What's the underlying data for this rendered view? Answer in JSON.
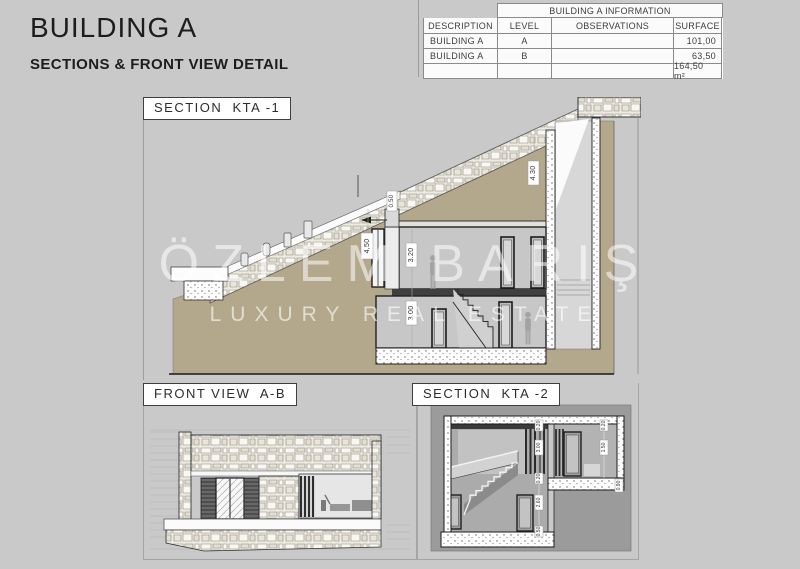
{
  "page": {
    "background": "#c9c9c9"
  },
  "header": {
    "title": "BUILDING A",
    "subtitle": "SECTIONS & FRONT VIEW DETAIL"
  },
  "info_table": {
    "title": "BUILDING A INFORMATION",
    "columns": [
      "DESCRIPTION",
      "LEVEL",
      "OBSERVATIONS",
      "SURFACE"
    ],
    "rows": [
      [
        "BUILDING A",
        "A",
        "",
        "101,00"
      ],
      [
        "BUILDING A",
        "B",
        "",
        "63,50"
      ]
    ],
    "total": "164,50 m²"
  },
  "panels": {
    "kta1": {
      "label": "SECTION  KTA -1"
    },
    "front": {
      "label": "FRONT VIEW  A-B"
    },
    "kta2": {
      "label": "SECTION  KTA -2"
    }
  },
  "dims": {
    "kta1": {
      "porch": "4,50",
      "upper_room": "3.20",
      "lower_room": "3.00",
      "right_wall": "4.30",
      "entry_step": "0.50"
    },
    "kta2": [
      "0.20",
      "3.00",
      "0.20",
      "2.60",
      "0.50",
      "0.20",
      "1.50",
      "0.90"
    ]
  },
  "watermark": {
    "line1": "ÖZLEM BARIŞ",
    "line2": "LUXURY REAL ESTATE"
  },
  "colors": {
    "earth": "#b3a78c",
    "kta2_background": "#9b9b9b",
    "room_gray": "#c7c7c7",
    "line_dark": "#222222"
  }
}
